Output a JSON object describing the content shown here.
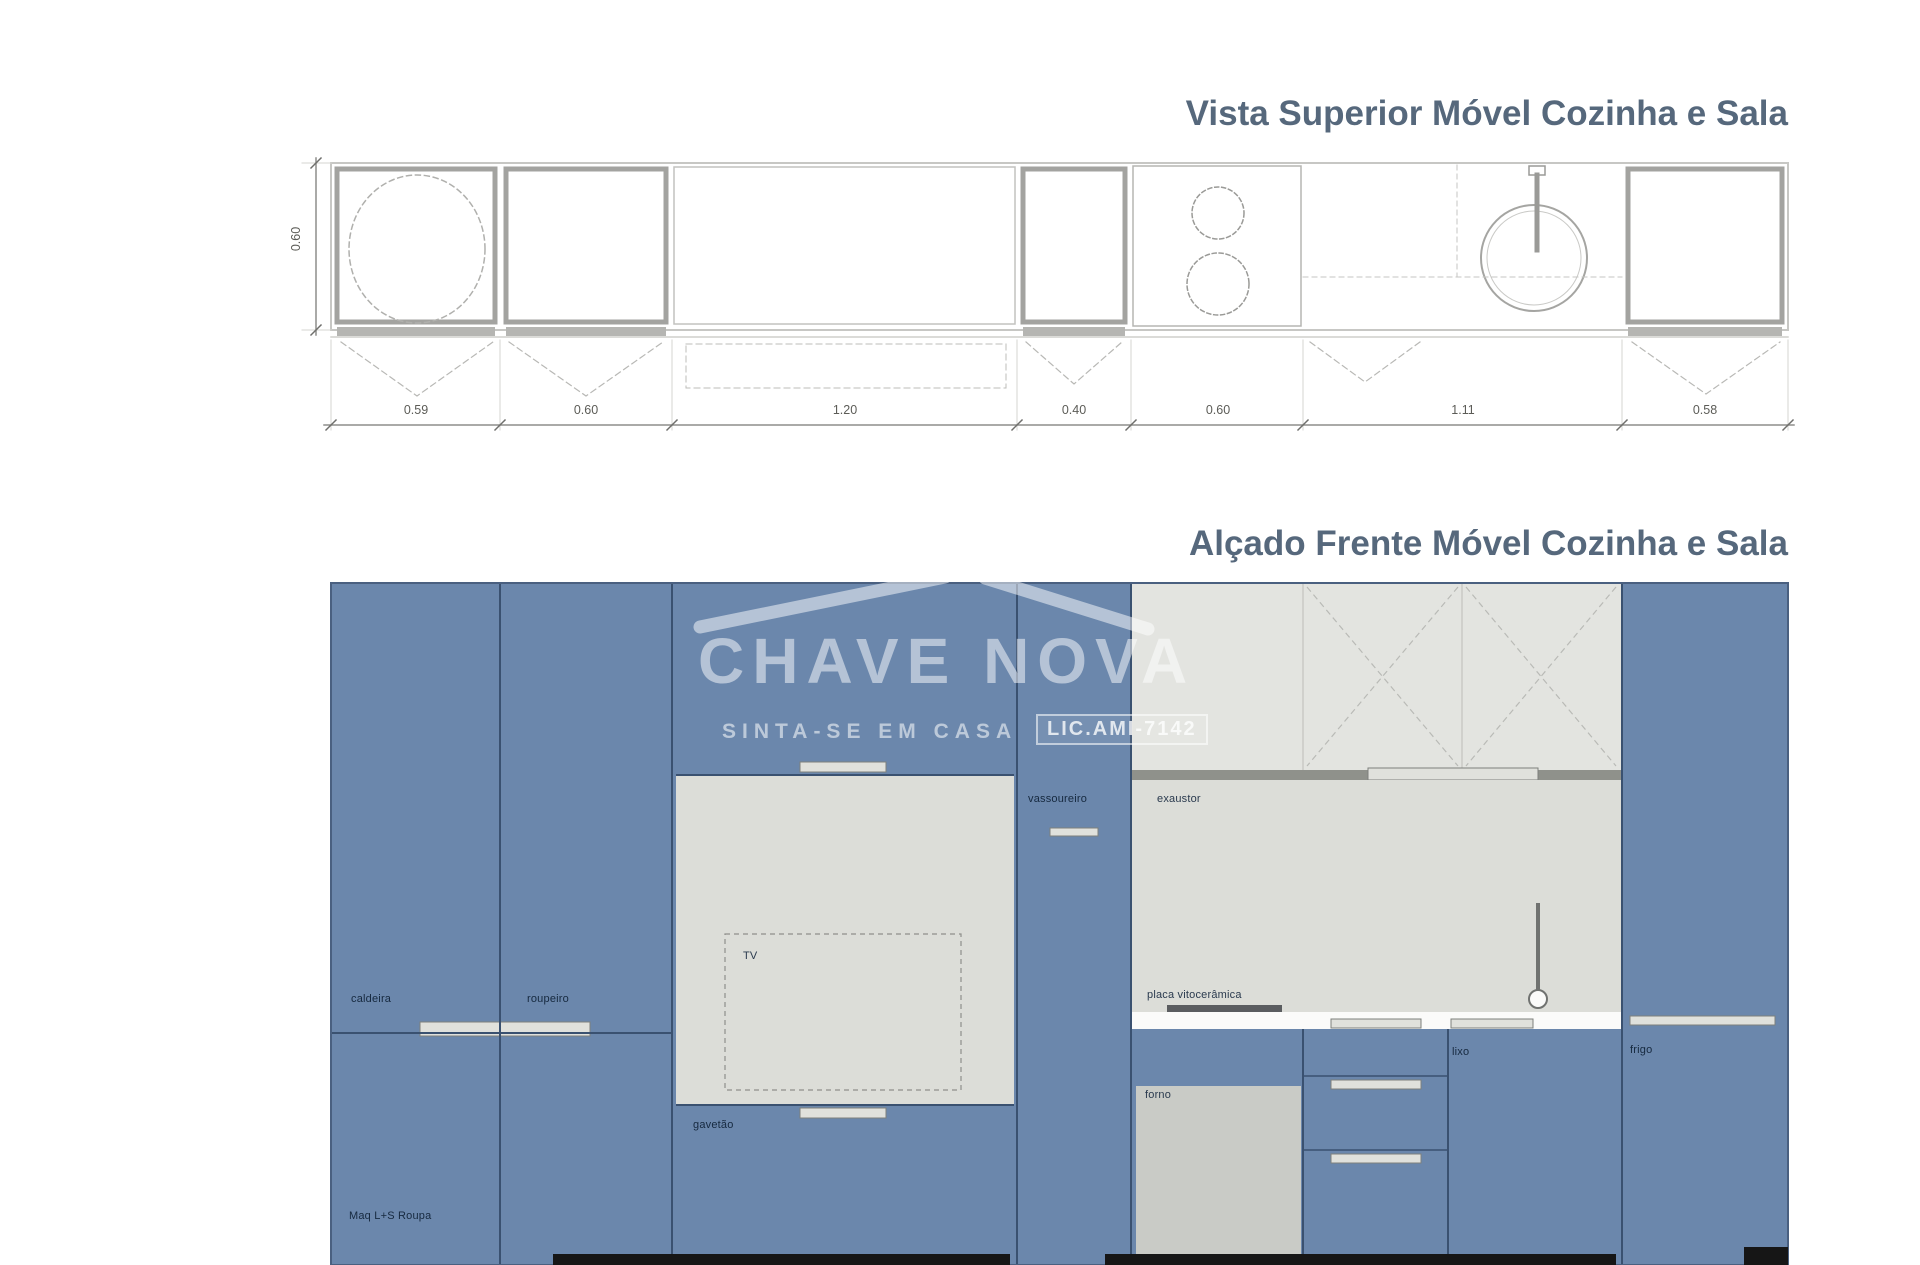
{
  "plan": {
    "title": "Vista Superior Móvel Cozinha e Sala",
    "side_dimension": "0.60",
    "dimensions": [
      "0.59",
      "0.60",
      "1.20",
      "0.40",
      "0.60",
      "1.11",
      "0.58"
    ]
  },
  "elevation": {
    "title": "Alçado Frente Móvel Cozinha e Sala",
    "labels": {
      "caldeira": "caldeira",
      "roupeiro": "roupeiro",
      "tv": "TV",
      "gavetao": "gavetão",
      "maq_roupa": "Maq L+S Roupa",
      "vassoureiro": "vassoureiro",
      "exaustor": "exaustor",
      "placa": "placa vitocerâmica",
      "forno": "forno",
      "lixo": "lixo",
      "frigo": "frigo"
    }
  },
  "watermark": {
    "brand": "CHAVE NOVA",
    "tagline": "SINTA-SE EM CASA",
    "license": "LIC.AMI-7142"
  },
  "colors": {
    "cabinet_blue": "#6b87ac",
    "panel_light_gray": "#e3e4e0",
    "niche_gray": "#dcddd8",
    "oven_gray": "#c9cbc6",
    "divider_dark": "#3a5170",
    "countertop_white": "#fbfbfa",
    "title_color": "#56687c",
    "plan_line_gray": "#a3a3a0"
  }
}
